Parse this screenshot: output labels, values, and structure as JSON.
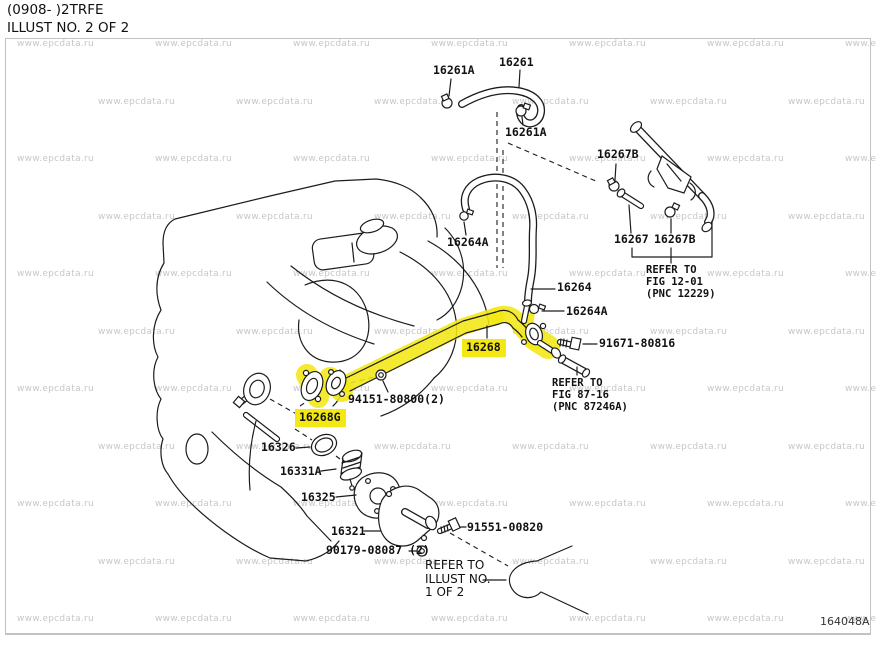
{
  "header": {
    "model_code": "(0908- )2TRFE",
    "illust_no": "ILLUST NO. 2 OF 2"
  },
  "watermark": {
    "text": "www.epcdata.ru"
  },
  "footer": {
    "drawing_code": "164048A"
  },
  "colors": {
    "highlight": "#f3e714",
    "line": "#1c1c1c",
    "watermark": "#c7c7c7",
    "border": "#c2c2c2",
    "text": "#111111"
  },
  "parts": [
    {
      "id": "16261A-top",
      "label": "16261A",
      "x": 433,
      "y": 64,
      "highlight": false
    },
    {
      "id": "16261",
      "label": "16261",
      "x": 499,
      "y": 56,
      "highlight": false
    },
    {
      "id": "16261A-mid",
      "label": "16261A",
      "x": 505,
      "y": 126,
      "highlight": false
    },
    {
      "id": "16267B-top",
      "label": "16267B",
      "x": 597,
      "y": 148,
      "highlight": false
    },
    {
      "id": "16264A-top",
      "label": "16264A",
      "x": 447,
      "y": 236,
      "highlight": false
    },
    {
      "id": "16267",
      "label": "16267",
      "x": 614,
      "y": 233,
      "highlight": false
    },
    {
      "id": "16267B-bottom",
      "label": "16267B",
      "x": 654,
      "y": 233,
      "highlight": false
    },
    {
      "id": "16264",
      "label": "16264",
      "x": 557,
      "y": 281,
      "highlight": false
    },
    {
      "id": "16264A-bottom",
      "label": "16264A",
      "x": 566,
      "y": 305,
      "highlight": false
    },
    {
      "id": "16268",
      "label": "16268",
      "x": 462,
      "y": 339,
      "highlight": true
    },
    {
      "id": "91671-80816",
      "label": "91671-80816",
      "x": 599,
      "y": 337,
      "highlight": false
    },
    {
      "id": "94151-80800",
      "label": "94151-80800(2)",
      "x": 348,
      "y": 393,
      "highlight": false
    },
    {
      "id": "16268G",
      "label": "16268G",
      "x": 295,
      "y": 409,
      "highlight": true
    },
    {
      "id": "16326",
      "label": "16326",
      "x": 261,
      "y": 441,
      "highlight": false
    },
    {
      "id": "16331A",
      "label": "16331A",
      "x": 280,
      "y": 465,
      "highlight": false
    },
    {
      "id": "16325",
      "label": "16325",
      "x": 301,
      "y": 491,
      "highlight": false
    },
    {
      "id": "16321",
      "label": "16321",
      "x": 331,
      "y": 525,
      "highlight": false
    },
    {
      "id": "91551-00820",
      "label": "91551-00820",
      "x": 467,
      "y": 521,
      "highlight": false
    },
    {
      "id": "90179-08087",
      "label": "90179-08087 (2)",
      "x": 326,
      "y": 544,
      "highlight": false
    }
  ],
  "notes": [
    {
      "id": "fig-12-01",
      "style": "mono",
      "x": 646,
      "y": 264,
      "lines": [
        "REFER TO",
        "FIG 12-01",
        "(PNC 12229)"
      ]
    },
    {
      "id": "fig-87-16",
      "style": "mono",
      "x": 552,
      "y": 377,
      "lines": [
        "REFER TO",
        "FIG 87-16",
        "(PNC 87246A)"
      ]
    },
    {
      "id": "illust-1-of-2",
      "style": "plain",
      "x": 425,
      "y": 559,
      "lines": [
        "REFER TO",
        "ILLUST NO.",
        "1 OF 2"
      ]
    }
  ]
}
